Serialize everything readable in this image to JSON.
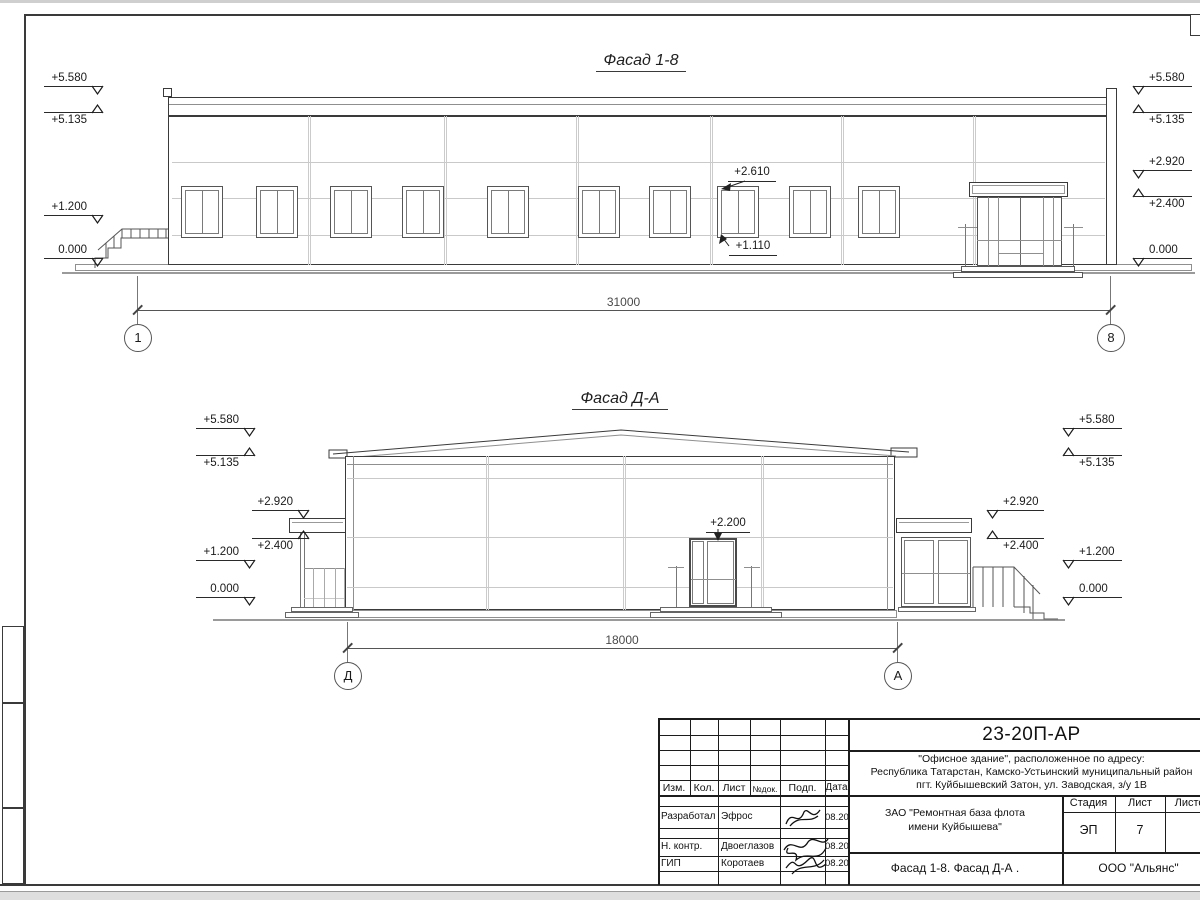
{
  "f1": {
    "title": "Фасад 1-8",
    "dim": "31000",
    "ax_l": "1",
    "ax_r": "8",
    "a_top": "+2.610",
    "a_bot": "+1.110",
    "ml": [
      {
        "t": "+5.580"
      },
      {
        "t": "+5.135"
      },
      {
        "t": "+1.200"
      },
      {
        "t": "0.000"
      }
    ],
    "mr": [
      {
        "t": "+5.580"
      },
      {
        "t": "+5.135"
      },
      {
        "t": "+2.920"
      },
      {
        "t": "+2.400"
      },
      {
        "t": "0.000"
      }
    ]
  },
  "f2": {
    "title": "Фасад Д-А",
    "dim": "18000",
    "ax_l": "Д",
    "ax_r": "А",
    "a_door": "+2.200",
    "ml": [
      {
        "t": "+5.580"
      },
      {
        "t": "+5.135"
      },
      {
        "t": "+1.200"
      },
      {
        "t": "0.000"
      }
    ],
    "mli": [
      {
        "t": "+2.920"
      },
      {
        "t": "+2.400"
      }
    ],
    "mr": [
      {
        "t": "+5.580"
      },
      {
        "t": "+5.135"
      },
      {
        "t": "+1.200"
      },
      {
        "t": "0.000"
      }
    ],
    "mri": [
      {
        "t": "+2.920"
      },
      {
        "t": "+2.400"
      }
    ]
  },
  "tb": {
    "doc_number": "23-20П-АР",
    "address1": "\"Офисное здание\", расположенное по адресу:",
    "address2": "Республика Татарстан, Камско-Устьинский муниципальный район",
    "address3": "пгт. Куйбышевский Затон, ул. Заводская, з/у 1В",
    "client1": "ЗАО \"Ремонтная база флота",
    "client2": "имени Куйбышева\"",
    "stage_label": "Стадия",
    "list_label": "Лист",
    "listov_label": "Листов",
    "stage": "ЭП",
    "sheet_no": "7",
    "sheet_title": "Фасад 1-8. Фасад Д-А .",
    "company": "ООО \"Альянс\"",
    "cols": {
      "izm": "Изм.",
      "kol": "Кол.",
      "list": "Лист",
      "ndok": "№док.",
      "podp": "Подп.",
      "data": "Дата"
    },
    "r1_role": "Разработал",
    "r1_name": "Эфрос",
    "r1_date": "08.20",
    "r2_role": "Н. контр.",
    "r2_name": "Двоеглазов",
    "r2_date": "08.20",
    "r3_role": "ГИП",
    "r3_name": "Коротаев",
    "r3_date": "08.20"
  }
}
